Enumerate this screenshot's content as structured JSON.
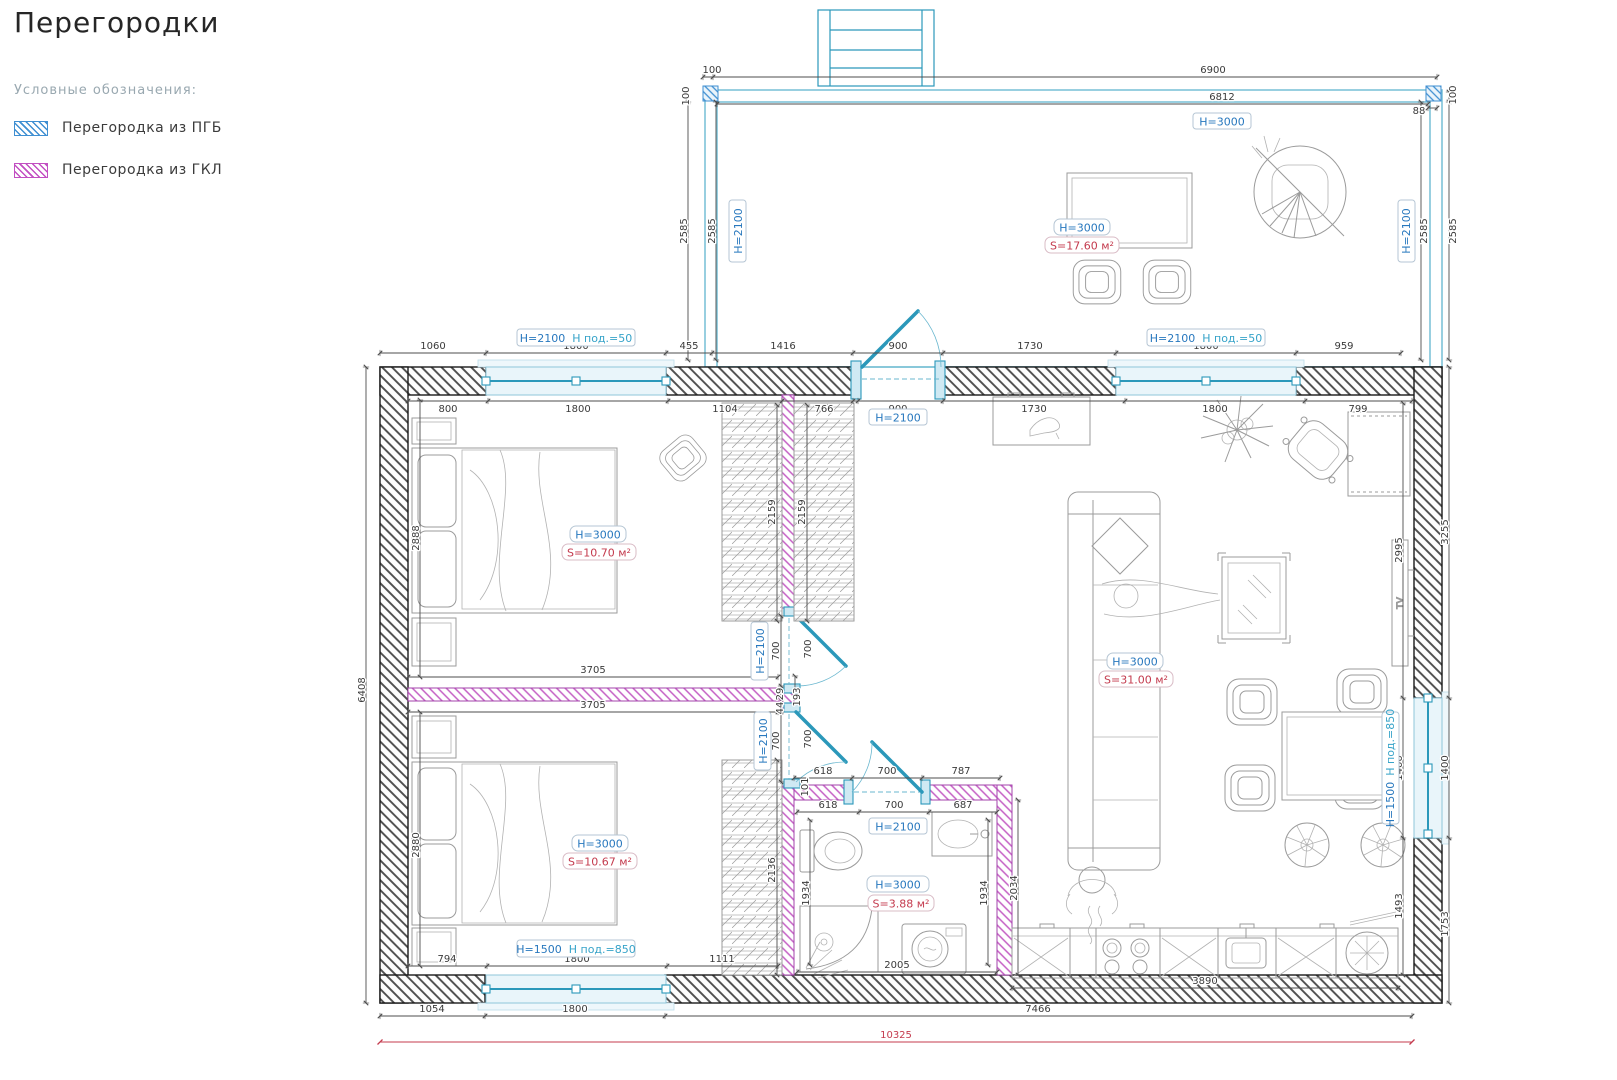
{
  "title": "Перегородки",
  "legend": {
    "heading": "Условные обозначения:",
    "items": [
      {
        "label": "Перегородка из ПГБ"
      },
      {
        "label": "Перегородка из ГКЛ"
      }
    ]
  },
  "colors": {
    "pgb": "#3f8fd2",
    "gkl": "#c24fc2",
    "wall_hatch": "#4d4d4d",
    "door_window": "#2b98ba",
    "height_label": "#2878be",
    "area_label": "#c43b4e",
    "sill_label": "#36a3c9",
    "total_dim": "#c43b4e"
  },
  "rooms": {
    "veranda": {
      "h": "H=3000",
      "s": "S=17.60 м²"
    },
    "bedroom1": {
      "h": "H=3000",
      "s": "S=10.70 м²"
    },
    "bedroom2": {
      "h": "H=3000",
      "s": "S=10.67 м²"
    },
    "bathroom": {
      "h": "H=3000",
      "s": "S=3.88 м²"
    },
    "living": {
      "h": "H=3000",
      "s": "S=31.00 м²"
    }
  },
  "openings": {
    "win_top_left": {
      "h": "H=2100",
      "sill": "Н под.=50"
    },
    "win_top_right": {
      "h": "H=2100",
      "sill": "Н под.=50"
    },
    "win_bottom": {
      "h": "H=1500",
      "sill": "Н под.=850"
    },
    "win_right": {
      "h": "H=1500",
      "sill": "Н под.=850"
    },
    "door_entry": "H=2100",
    "door_bed1": "H=2100",
    "door_bed2": "H=2100",
    "door_bath": "H=2100",
    "veranda_wall_h": "H=3000"
  },
  "furniture": {
    "tv": "TV"
  },
  "dims": {
    "top_outer": [
      "1060",
      "1800",
      "455",
      "1416",
      "900",
      "1730",
      "1800",
      "959"
    ],
    "top_inner_left": [
      "800",
      "1800",
      "1104",
      "766"
    ],
    "top_inner_right": [
      "900",
      "1730",
      "1800",
      "799"
    ],
    "veranda": {
      "tick_left": "100",
      "outer": "6900",
      "inner": "6812",
      "left_post": "100",
      "left": [
        "2585",
        "2585"
      ],
      "right_gap": "88",
      "right_post": "100",
      "right": [
        "2585",
        "2585"
      ]
    },
    "left": {
      "total": "6408",
      "bed1": "2888",
      "bed2": "2880"
    },
    "bed1": {
      "bottom": "3705",
      "wardrobe": [
        "2159",
        "2159"
      ]
    },
    "bed2": {
      "top": "3705",
      "wardrobe": "2136"
    },
    "hall": {
      "door1_w": "700",
      "door1_swing": "700",
      "gap1": "29",
      "gap2": "44",
      "gap3": "193",
      "door2_w": "700",
      "door2_swing": "700",
      "gap4": "101"
    },
    "bath": {
      "outer": [
        "618",
        "700",
        "787"
      ],
      "inner": [
        "618",
        "700",
        "687"
      ],
      "left": "1934",
      "right": "1934",
      "kitchen": "2034",
      "bottom": "2005"
    },
    "right": {
      "outer": [
        "3255",
        "1400",
        "1753"
      ],
      "inner": [
        "2995",
        "1400",
        "1493"
      ]
    },
    "bottom_inner": [
      "794",
      "1800",
      "1111"
    ],
    "kitchen_counter": "3890",
    "bottom_outer": [
      "1054",
      "1800",
      "7466"
    ],
    "total": "10325"
  }
}
